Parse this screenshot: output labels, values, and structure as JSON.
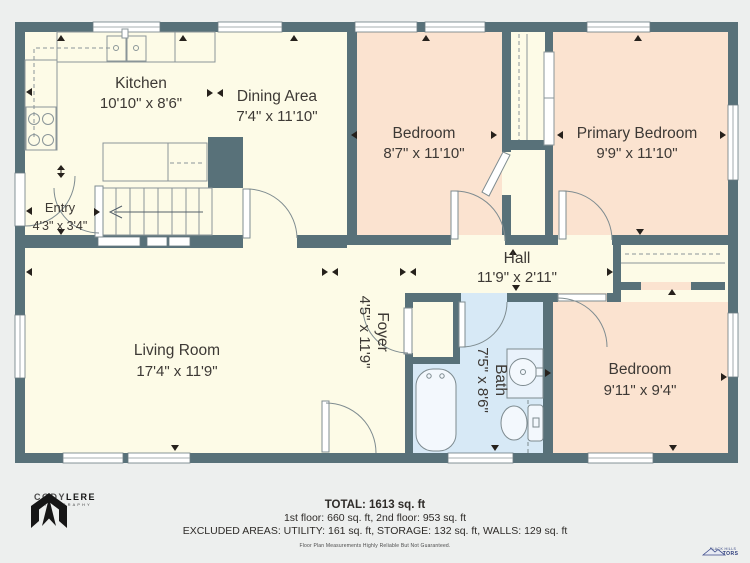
{
  "plan": {
    "rooms": [
      {
        "id": "kitchen",
        "name": "Kitchen",
        "dims": "10'10\" x 8'6\""
      },
      {
        "id": "dining-area",
        "name": "Dining Area",
        "dims": "7'4\" x 11'10\""
      },
      {
        "id": "entry",
        "name": "Entry",
        "dims": "4'3\" x 3'4\""
      },
      {
        "id": "bedroom-1",
        "name": "Bedroom",
        "dims": "8'7\" x 11'10\""
      },
      {
        "id": "primary-bedroom",
        "name": "Primary Bedroom",
        "dims": "9'9\" x 11'10\""
      },
      {
        "id": "hall",
        "name": "Hall",
        "dims": "11'9\" x 2'11\""
      },
      {
        "id": "living-room",
        "name": "Living Room",
        "dims": "17'4\" x 11'9\""
      },
      {
        "id": "foyer",
        "name": "Foyer",
        "dims": "4'5\" x 11'9\""
      },
      {
        "id": "bath",
        "name": "Bath",
        "dims": "7'5\" x 8'6\""
      },
      {
        "id": "bedroom-2",
        "name": "Bedroom",
        "dims": "9'11\" x 9'4\""
      }
    ],
    "colors": {
      "wall": "#587179",
      "floor_main": "#fdfbe7",
      "floor_bedroom": "#fbe3d0",
      "floor_bath": "#d7e9f6",
      "background": "#edefee",
      "fixture_line": "#7d8a8f"
    }
  },
  "footer": {
    "total": "TOTAL: 1613 sq. ft",
    "floors": "1st floor: 660 sq. ft, 2nd floor: 953 sq. ft",
    "excluded": "EXCLUDED AREAS: UTILITY: 161 sq. ft, STORAGE: 132 sq. ft, WALLS: 129 sq. ft",
    "disclaimer": "Floor Plan Measurements Highly Reliable But Not Guaranteed."
  },
  "branding": {
    "photographer": {
      "name_a": "CODY",
      "name_b": "LERE",
      "subtitle": "PHOTOGRAPHY"
    },
    "realtor": {
      "line1": "BLACK HILLS",
      "line2": "REALTORS"
    }
  }
}
